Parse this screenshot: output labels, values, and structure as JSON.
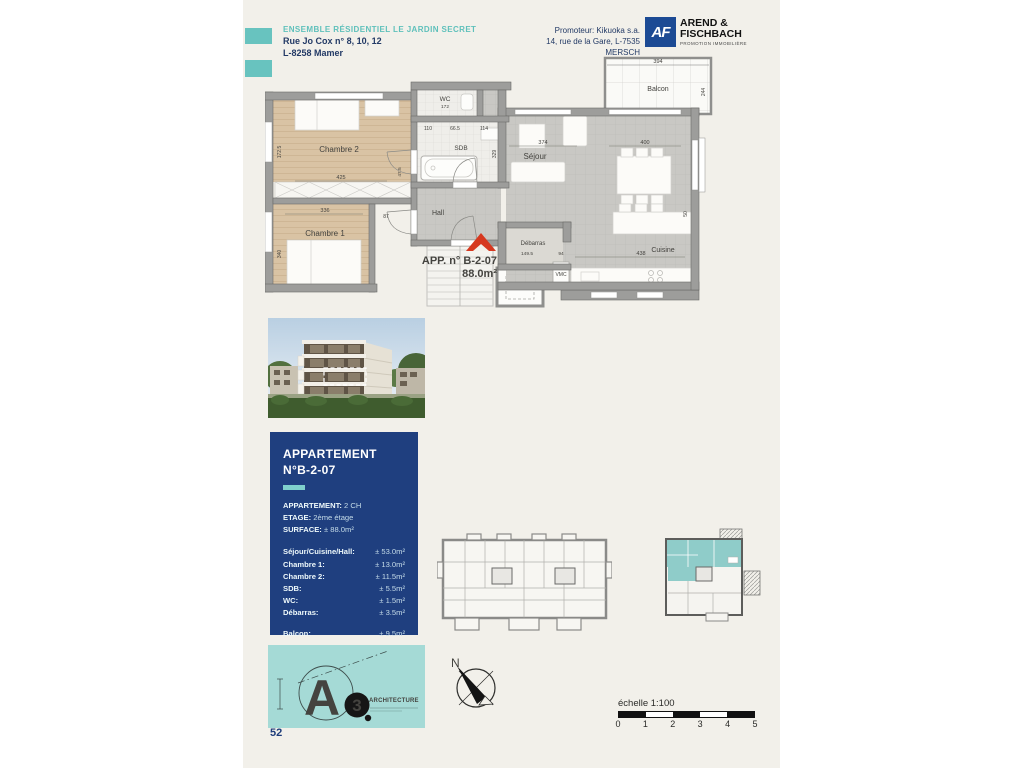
{
  "page": {
    "number": "52"
  },
  "header": {
    "project_title": "ENSEMBLE RÉSIDENTIEL LE JARDIN SECRET",
    "address_line1": "Rue Jo Cox n° 8, 10, 12",
    "address_line2": "L-8258 Mamer",
    "promoter_line1": "Promoteur: Kikuoka s.a.",
    "promoter_line2": "14, rue de la Gare, L-7535 MERSCH",
    "logo": {
      "initials": "AF",
      "name_line1": "AREND &",
      "name_line2": "FISCHBACH",
      "tagline": "PROMOTION IMMOBILIÈRE"
    }
  },
  "floor_plan": {
    "apartment_label": "APP. n° B-2-07",
    "apartment_area": "88.0m²",
    "rooms": {
      "chambre2": "Chambre 2",
      "chambre1": "Chambre 1",
      "wc": "WC",
      "sdb": "SDB",
      "hall": "Hall",
      "sejour": "Séjour",
      "debarras": "Débarras",
      "cuisine": "Cuisine",
      "balcon": "Balcon",
      "vmc": "VMC"
    },
    "dims": {
      "balcon_w": "394",
      "balcon_h": "244",
      "sejour_w": "374",
      "sejour_w2": "400",
      "chambre2_w": "425",
      "chambre2_h": "172.5",
      "chambre1_w": "336",
      "chambre1_h": "340",
      "cuisine_w": "438",
      "cuisine_h": "50",
      "debarras_w": "149.5",
      "debarras_door": "94",
      "wc_h": "172",
      "sdb_h": "329",
      "hall_d1": "110",
      "hall_d2": "66.5",
      "hall_d3": "114",
      "door_w": "87",
      "door_h": "47.5"
    }
  },
  "info_panel": {
    "title_line1": "APPARTEMENT",
    "title_line2": "N°B-2-07",
    "details": [
      {
        "label": "APPARTEMENT:",
        "value": "2 CH"
      },
      {
        "label": "ETAGE:",
        "value": "2ème étage"
      },
      {
        "label": "SURFACE:",
        "value": "± 88.0m²"
      }
    ],
    "areas": [
      {
        "label": "Séjour/Cuisine/Hall:",
        "value": "± 53.0m²"
      },
      {
        "label": "Chambre 1:",
        "value": "± 13.0m²"
      },
      {
        "label": "Chambre 2:",
        "value": "± 11.5m²"
      },
      {
        "label": "SDB:",
        "value": "± 5.5m²"
      },
      {
        "label": "WC:",
        "value": "± 1.5m²"
      },
      {
        "label": "Débarras:",
        "value": "± 3.5m²"
      },
      {
        "label": "Balcon:",
        "value": "± 9.5m²"
      }
    ]
  },
  "architect": {
    "letter": "A",
    "number": "3",
    "name": "ARCHITECTURE"
  },
  "compass": {
    "north": "N"
  },
  "scale_bar": {
    "label": "échelle 1:100",
    "ticks": [
      "0",
      "1",
      "2",
      "3",
      "4",
      "5"
    ]
  }
}
